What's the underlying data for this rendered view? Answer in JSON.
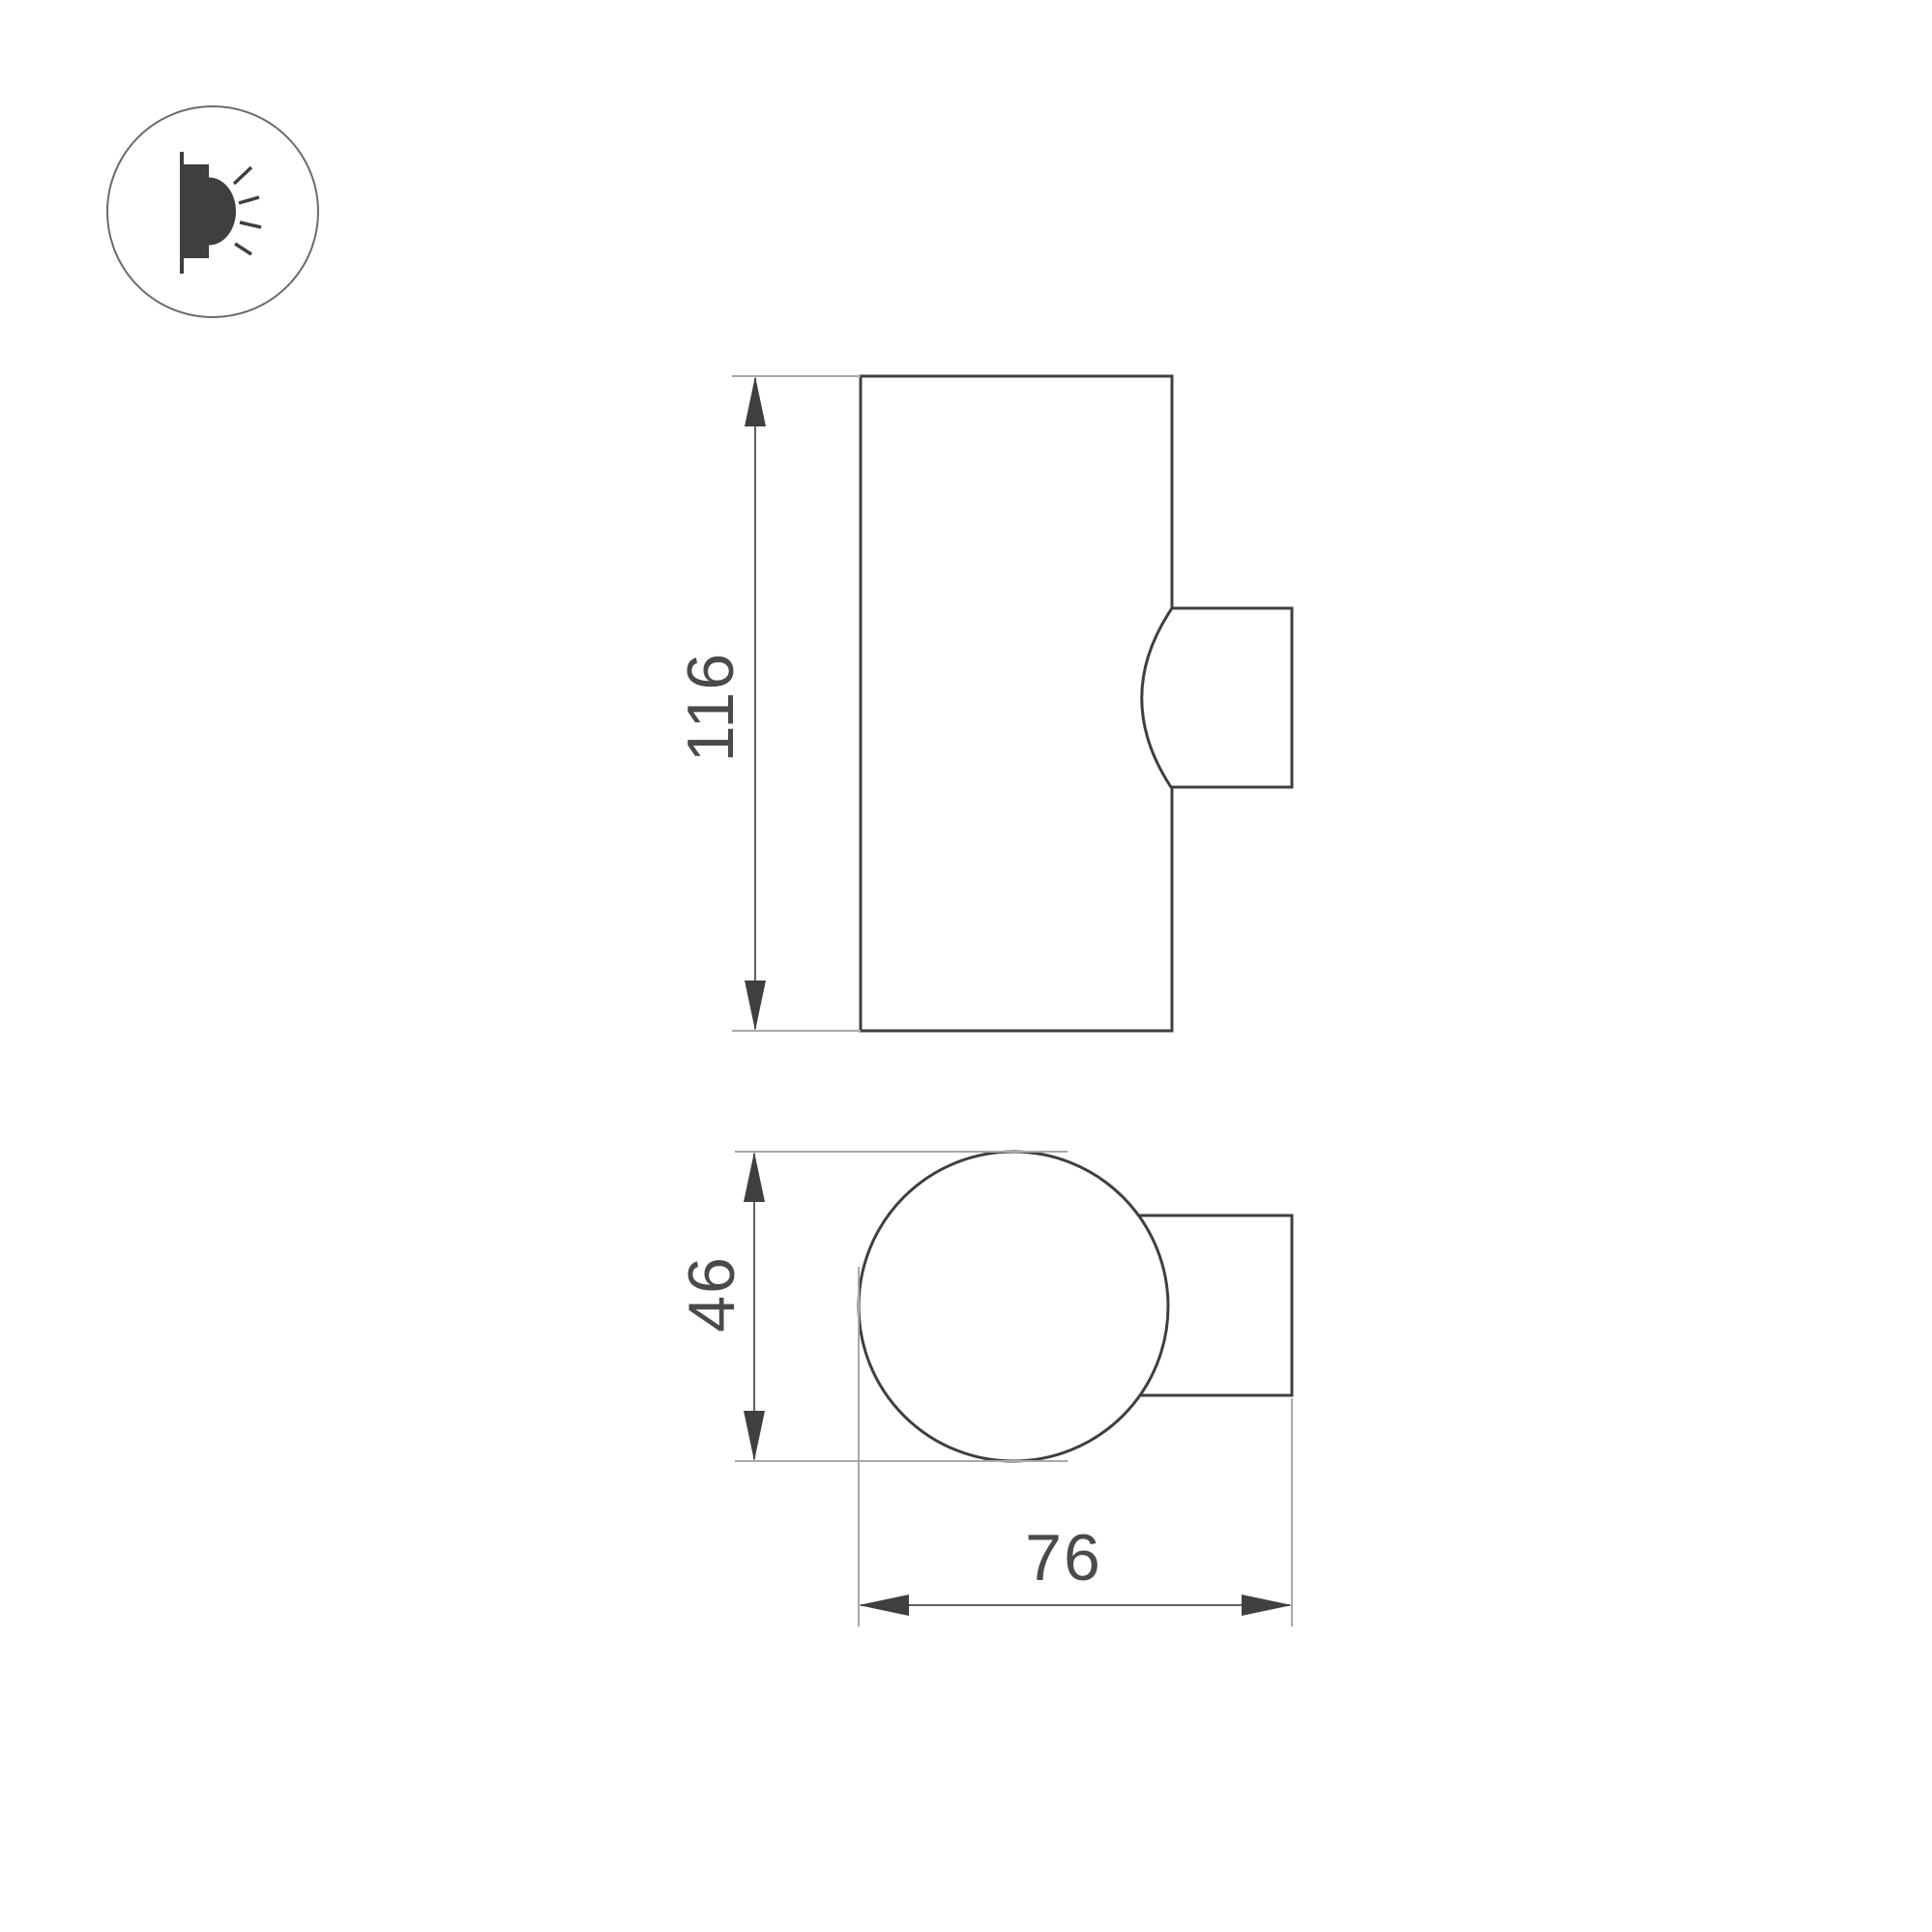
{
  "icon": {
    "circle_stroke": "#6b6b6b",
    "glyph_color": "#3f3f3f"
  },
  "drawing": {
    "outline_color": "#3f3f3f",
    "dimension_line_color": "#606060",
    "extension_line_color": "#a9a9a9",
    "arrow_color": "#3f3f3f",
    "text_color": "#4a4a4a"
  },
  "front_view": {
    "height_dimension": "116"
  },
  "top_view": {
    "diameter_dimension": "46",
    "depth_dimension": "76"
  }
}
